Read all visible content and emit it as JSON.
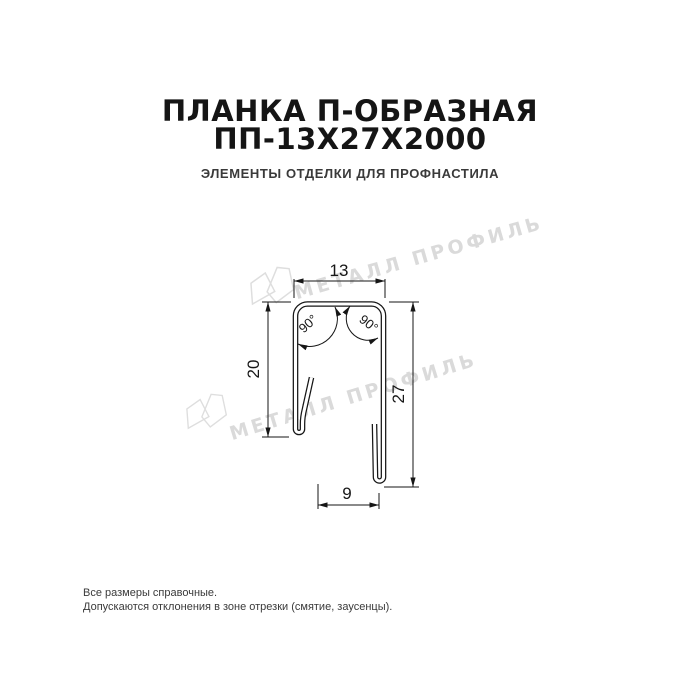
{
  "header": {
    "title_line1": "ПЛАНКА П-ОБРАЗНАЯ",
    "title_line2": "ПП-13Х27Х2000",
    "subtitle": "ЭЛЕМЕНТЫ ОТДЕЛКИ ДЛЯ ПРОФНАСТИЛА",
    "title_color": "#151515",
    "subtitle_color": "#3a3a3a"
  },
  "drawing": {
    "type": "technical-profile-cross-section",
    "product": "Планка П-образная ПП-13Х27Х2000",
    "dimensions": {
      "top_width_mm": "13",
      "left_height_mm": "20",
      "right_height_mm": "27",
      "bottom_width_mm": "9",
      "left_angle": "90°",
      "right_angle": "90°"
    },
    "line_color": "#161616"
  },
  "watermark": {
    "text": "МЕТАЛЛ ПРОФИЛЬ",
    "color": "#dadada"
  },
  "footer": {
    "line1": "Все размеры справочные.",
    "line2": "Допускаются отклонения в зоне отрезки (смятие, заусенцы).",
    "color": "#3a3a3a"
  }
}
